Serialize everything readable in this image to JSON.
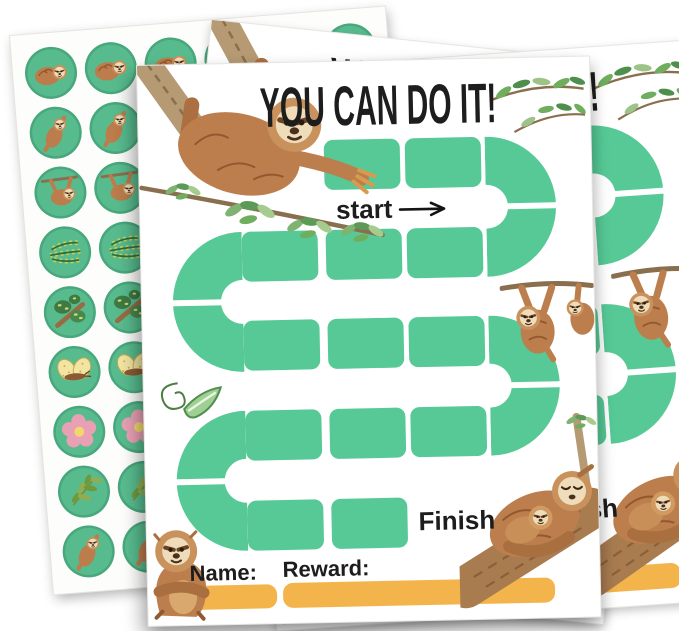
{
  "card": {
    "title": "YOU CAN DO IT!",
    "start_label": "start",
    "finish_label": "Finish",
    "name_label": "Name:",
    "reward_label": "Reward:"
  },
  "board": {
    "square": {
      "w": 76,
      "h": 50,
      "r": 9
    },
    "rows": [
      {
        "y": 78,
        "xs": [
          185,
          266
        ]
      },
      {
        "y": 168,
        "xs": [
          101,
          185,
          266
        ]
      },
      {
        "y": 257,
        "xs": [
          101,
          185,
          266
        ]
      },
      {
        "y": 347,
        "xs": [
          101,
          185,
          266
        ]
      },
      {
        "y": 437,
        "xs": [
          101,
          185
        ]
      }
    ],
    "turns": [
      {
        "side": "right",
        "x": 346,
        "y": 78
      },
      {
        "side": "left",
        "x": 27,
        "y": 168
      },
      {
        "side": "right",
        "x": 346,
        "y": 257
      },
      {
        "side": "left",
        "x": 27,
        "y": 347
      }
    ]
  },
  "sticker_sheet": {
    "cols": 6,
    "rows": [
      "sloth-curled",
      "sloth-climbing",
      "sloth-hanging",
      "fern",
      "tree",
      "butterfly",
      "flower",
      "leaf-sprig",
      "sloth-climbing"
    ]
  },
  "colors": {
    "path_green": "#56c996",
    "sticker_green": "#58bb8e",
    "bar_orange": "#f4b44c",
    "ink": "#1d1d1d"
  },
  "illustrations": [
    "sloth-on-branch",
    "olive-leaves",
    "hanging-sloths",
    "leaf-swirl",
    "sitting-sloth",
    "sloth-family-on-log"
  ]
}
